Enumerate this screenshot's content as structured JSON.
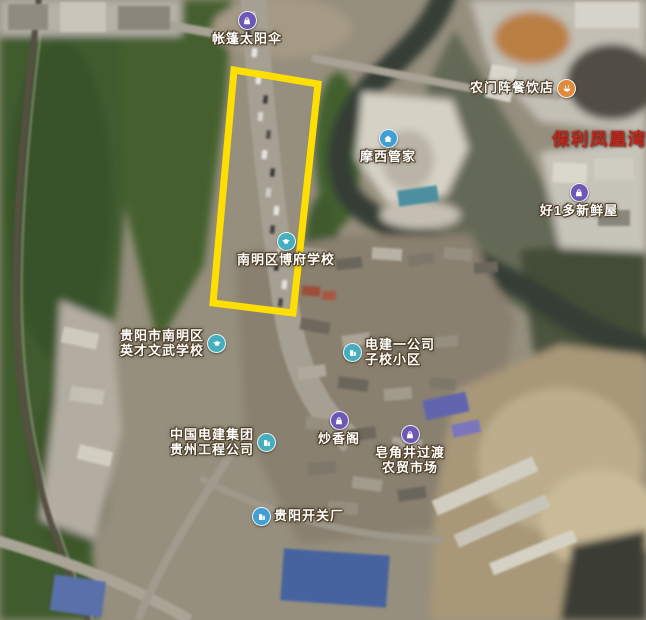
{
  "map": {
    "type": "satellite-imagery",
    "highlight": {
      "shape": "rectangle",
      "points": "234,70 318,84 293,313 213,303",
      "color": "#ffdf00"
    },
    "icon_colors": {
      "shopping": "#6e58b5",
      "restaurant": "#df8a3c",
      "education_company": "#46aebc",
      "service_factory": "#429fd4"
    },
    "label_colors": {
      "default": "#ffffff",
      "premium": "#c2271b"
    },
    "pois": [
      {
        "id": "tent-shop",
        "lines": [
          "帐篷太阳伞"
        ],
        "icon": "shopping-bag"
      },
      {
        "id": "restaurant-nongmenzhen",
        "lines": [
          "农门阵餐饮店"
        ],
        "icon": "restaurant"
      },
      {
        "id": "baoli-phoenix-bay",
        "lines": [
          "保利凤凰湾"
        ],
        "icon": null
      },
      {
        "id": "moxi-housekeeper",
        "lines": [
          "摩西管家"
        ],
        "icon": "home-service"
      },
      {
        "id": "hao1duo-fresh",
        "lines": [
          "好1多新鲜屋"
        ],
        "icon": "shopping-bag"
      },
      {
        "id": "bofu-school",
        "lines": [
          "南明区博府学校"
        ],
        "icon": "school"
      },
      {
        "id": "yingcai-school",
        "lines": [
          "贵阳市南明区",
          "英才文武学校"
        ],
        "icon": "school"
      },
      {
        "id": "dianjian-residence",
        "lines": [
          "电建一公司",
          "子校小区"
        ],
        "icon": "building"
      },
      {
        "id": "powerchina-guizhou",
        "lines": [
          "中国电建集团",
          "贵州工程公司"
        ],
        "icon": "building"
      },
      {
        "id": "chaoxiangge",
        "lines": [
          "炒香阁"
        ],
        "icon": "shopping-bag"
      },
      {
        "id": "zaojiaojing-market",
        "lines": [
          "皂角井过渡",
          "农贸市场"
        ],
        "icon": "shopping-bag"
      },
      {
        "id": "guiyang-switch-factory",
        "lines": [
          "贵阳开关厂"
        ],
        "icon": "building"
      }
    ]
  }
}
